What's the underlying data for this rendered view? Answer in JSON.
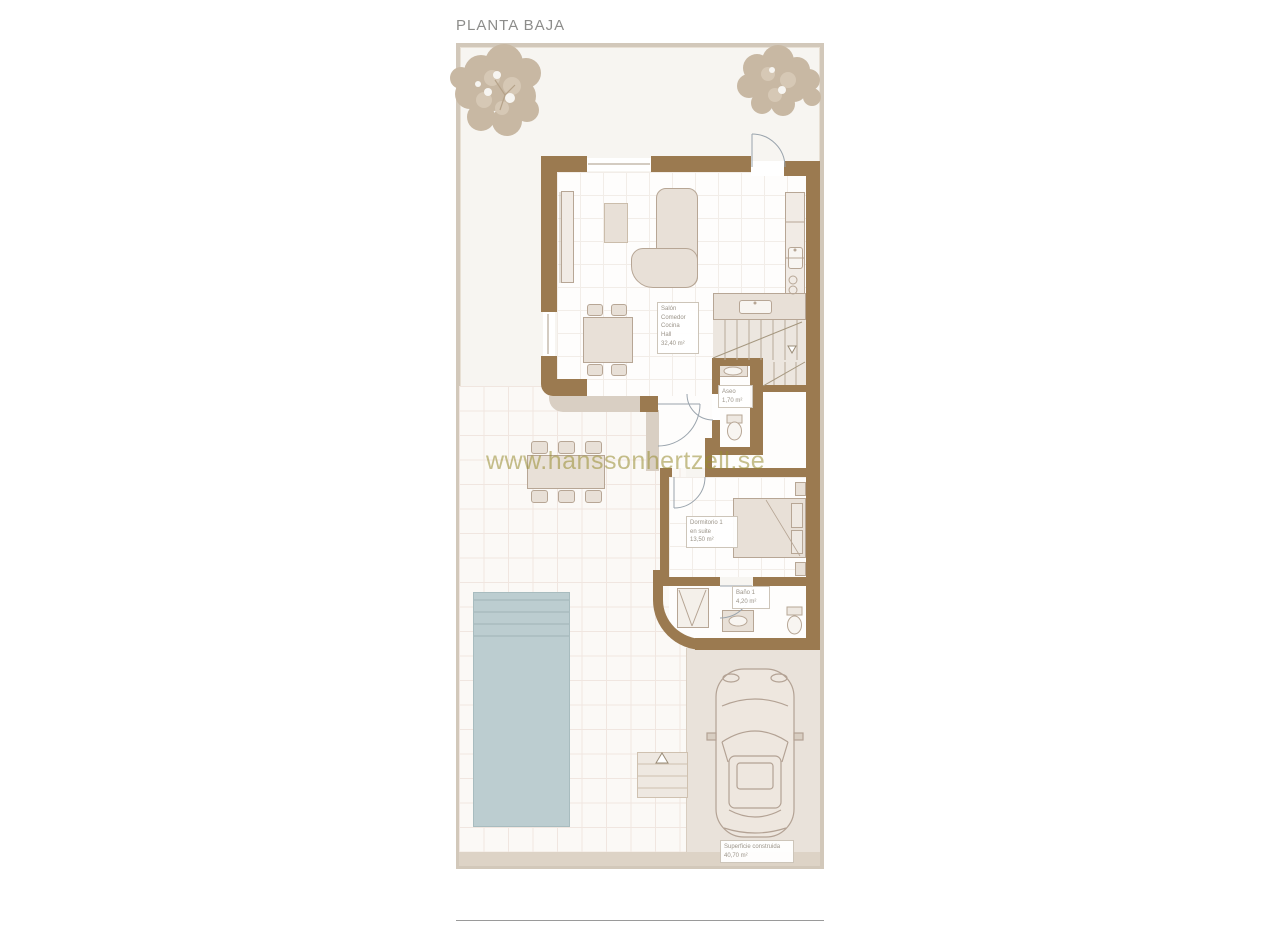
{
  "title": "PLANTA BAJA",
  "watermark": "www.hanssonhertzell.se",
  "rooms": {
    "salon": {
      "name1": "Salón",
      "name2": "Comedor",
      "name3": "Cocina",
      "name4": "Hall",
      "area": "32,40 m²"
    },
    "aseo": {
      "name1": "Aseo",
      "area": "1,70 m²"
    },
    "dormitorio": {
      "name1": "Dormitorio 1",
      "name2": "en suite",
      "area": "13,50 m²"
    },
    "bano": {
      "name1": "Baño 1",
      "area": "4,20 m²"
    },
    "superficie": {
      "name1": "Superficie construida",
      "area": "40,70 m²"
    }
  },
  "colors": {
    "wall": "#9b7a50",
    "pool": "#bccdd0",
    "plot_border": "#d2c8ba",
    "tree": "#c8b8a3",
    "watermark": "#988d2f"
  }
}
